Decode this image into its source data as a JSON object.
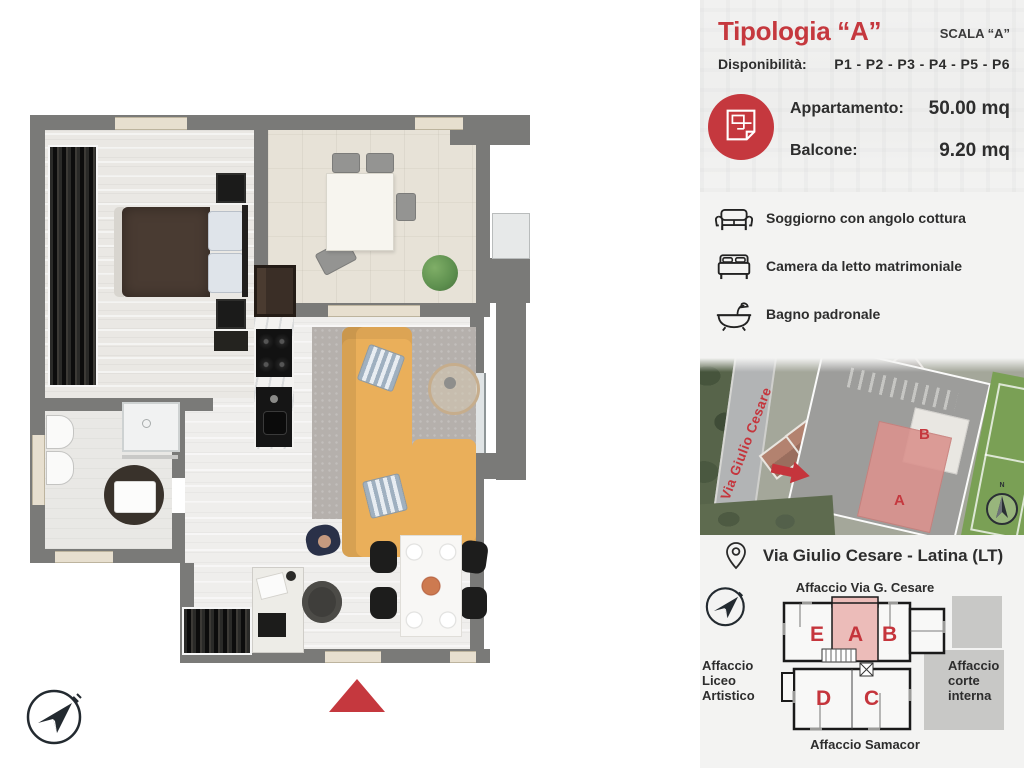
{
  "panel": {
    "title": "Tipologia “A”",
    "scala_label": "SCALA “A”",
    "disponibilita_label": "Disponibilità:",
    "disponibilita_value": "P1 - P2 - P3 - P4 - P5 - P6",
    "metrics": [
      {
        "label": "Appartamento:",
        "value": "50.00 mq"
      },
      {
        "label": "Balcone:",
        "value": "9.20 mq"
      }
    ],
    "features": [
      {
        "icon": "sofa-icon",
        "label": "Soggiorno con angolo cottura"
      },
      {
        "icon": "bed-icon",
        "label": "Camera da letto matrimoniale"
      },
      {
        "icon": "bathtub-icon",
        "label": "Bagno padronale"
      }
    ],
    "aerial_map": {
      "street_label": "Via Giulio Cesare",
      "unit_a": "A",
      "unit_b": "B",
      "compass_n": "N"
    },
    "address": "Via Giulio Cesare - Latina (LT)",
    "siteplan": {
      "affaccio_top": "Affaccio Via G. Cesare",
      "affaccio_left": "Affaccio Liceo Artistico",
      "affaccio_right": "Affaccio corte interna",
      "affaccio_bottom": "Affaccio Samacor",
      "unit_e": "E",
      "unit_a": "A",
      "unit_b": "B",
      "unit_d": "D",
      "unit_c": "C"
    }
  },
  "colors": {
    "accent": "#c5383e",
    "unit_highlight": "#ecbcb9",
    "wall_gray": "#7a7a78",
    "sofa_yellow": "#eaaf5a",
    "text_dark": "#2d2d2d",
    "panel_bg": "#f3f3f2"
  }
}
